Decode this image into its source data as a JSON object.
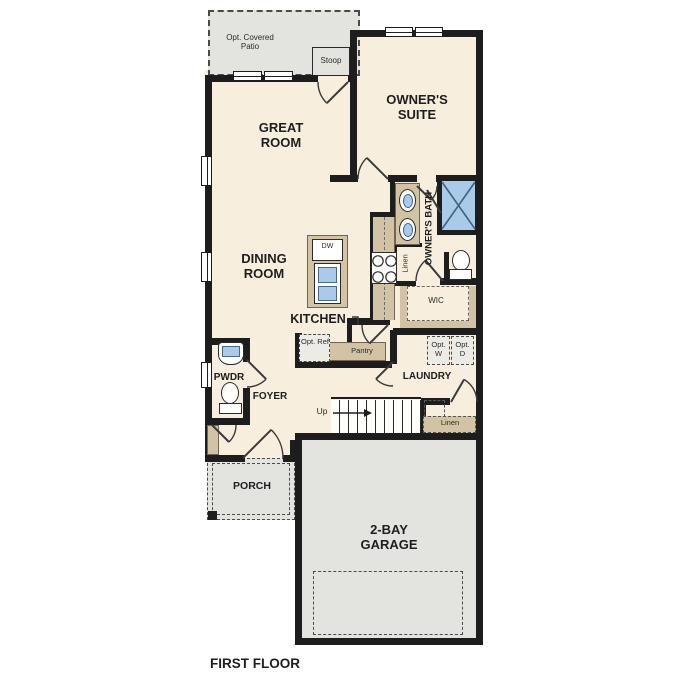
{
  "plan": {
    "title": "FIRST FLOOR",
    "rooms": {
      "patio": {
        "label": "Opt. Covered Patio"
      },
      "stoop": {
        "label": "Stoop"
      },
      "owners_suite": {
        "label": "OWNER'S SUITE"
      },
      "great_room": {
        "label": "GREAT ROOM"
      },
      "dining_room": {
        "label": "DINING ROOM"
      },
      "kitchen": {
        "label": "KITCHEN"
      },
      "owners_bath": {
        "label": "OWNER'S BATH"
      },
      "wic": {
        "label": "WIC"
      },
      "laundry": {
        "label": "LAUNDRY"
      },
      "pwdr": {
        "label": "PWDR"
      },
      "foyer": {
        "label": "FOYER"
      },
      "porch": {
        "label": "PORCH"
      },
      "garage": {
        "label": "2-BAY GARAGE"
      }
    },
    "fixtures": {
      "dishwasher": {
        "label": "DW"
      },
      "pantry": {
        "label": "Pantry"
      },
      "opt_ref": {
        "label": "Opt. Ref"
      },
      "opt_washer": {
        "label": "Opt. W"
      },
      "opt_dryer": {
        "label": "Opt. D"
      },
      "linen_bath": {
        "label": "Linen"
      },
      "linen_stairs": {
        "label": "Linen"
      },
      "stairs_up": {
        "label": "Up"
      }
    },
    "colors": {
      "floor": "#f7eedd",
      "exterior_concrete": "#e3e3e0",
      "wall": "#1d1d1d",
      "counter": "#d2c3a4",
      "water": "#a9cbe9"
    }
  }
}
